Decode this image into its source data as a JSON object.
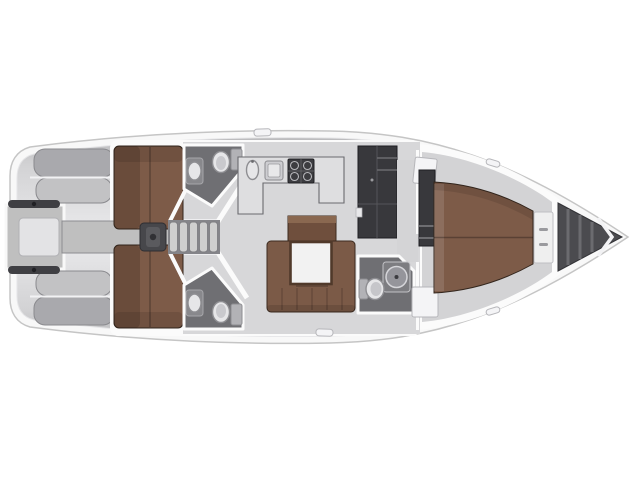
{
  "page": {
    "background": "#ffffff"
  },
  "vessel": {
    "view": "Top-down sailing yacht interior floor plan, bow pointing right",
    "rooms": [
      "cockpit",
      "swim-platform",
      "aft-cabin-port",
      "aft-cabin-starboard",
      "head-port",
      "head-starboard",
      "companionway",
      "galley",
      "salon",
      "nav-lockers",
      "forward-head",
      "forward-cabin",
      "anchor-locker"
    ]
  },
  "colors": {
    "bg": "#ffffff",
    "hull": "#f8f8f8",
    "hullStroke": "#c5c5c5",
    "deckDark": "#b4b4b6",
    "deckMid": "#d2d2d4",
    "deckLight": "#ebebed",
    "wall": "#fbfbfb",
    "floor": "#d7d7d9",
    "berthLight": "#7d5b48",
    "berthDark": "#6a4a3a",
    "berthEdge": "#33261d",
    "sofa": "#7b5a47",
    "woodTop": "#8a6850",
    "tableTop": "#f2f2f2",
    "tableFrame": "#50392a",
    "headFloor": "#6f6f73",
    "fixtureLight": "#e6e6e8",
    "fixtureMid": "#b2b2b6",
    "fixtureDark": "#8e8e92",
    "locker": "#38383c",
    "stove": "#3c3c40",
    "anchorLocker": "#4b4b4f",
    "bench": "#a9a9ad",
    "benchLight": "#c2c2c4",
    "corridor": "#bfbfbf",
    "steps": "#cfcfcf",
    "wheel": "#3f3f43"
  }
}
